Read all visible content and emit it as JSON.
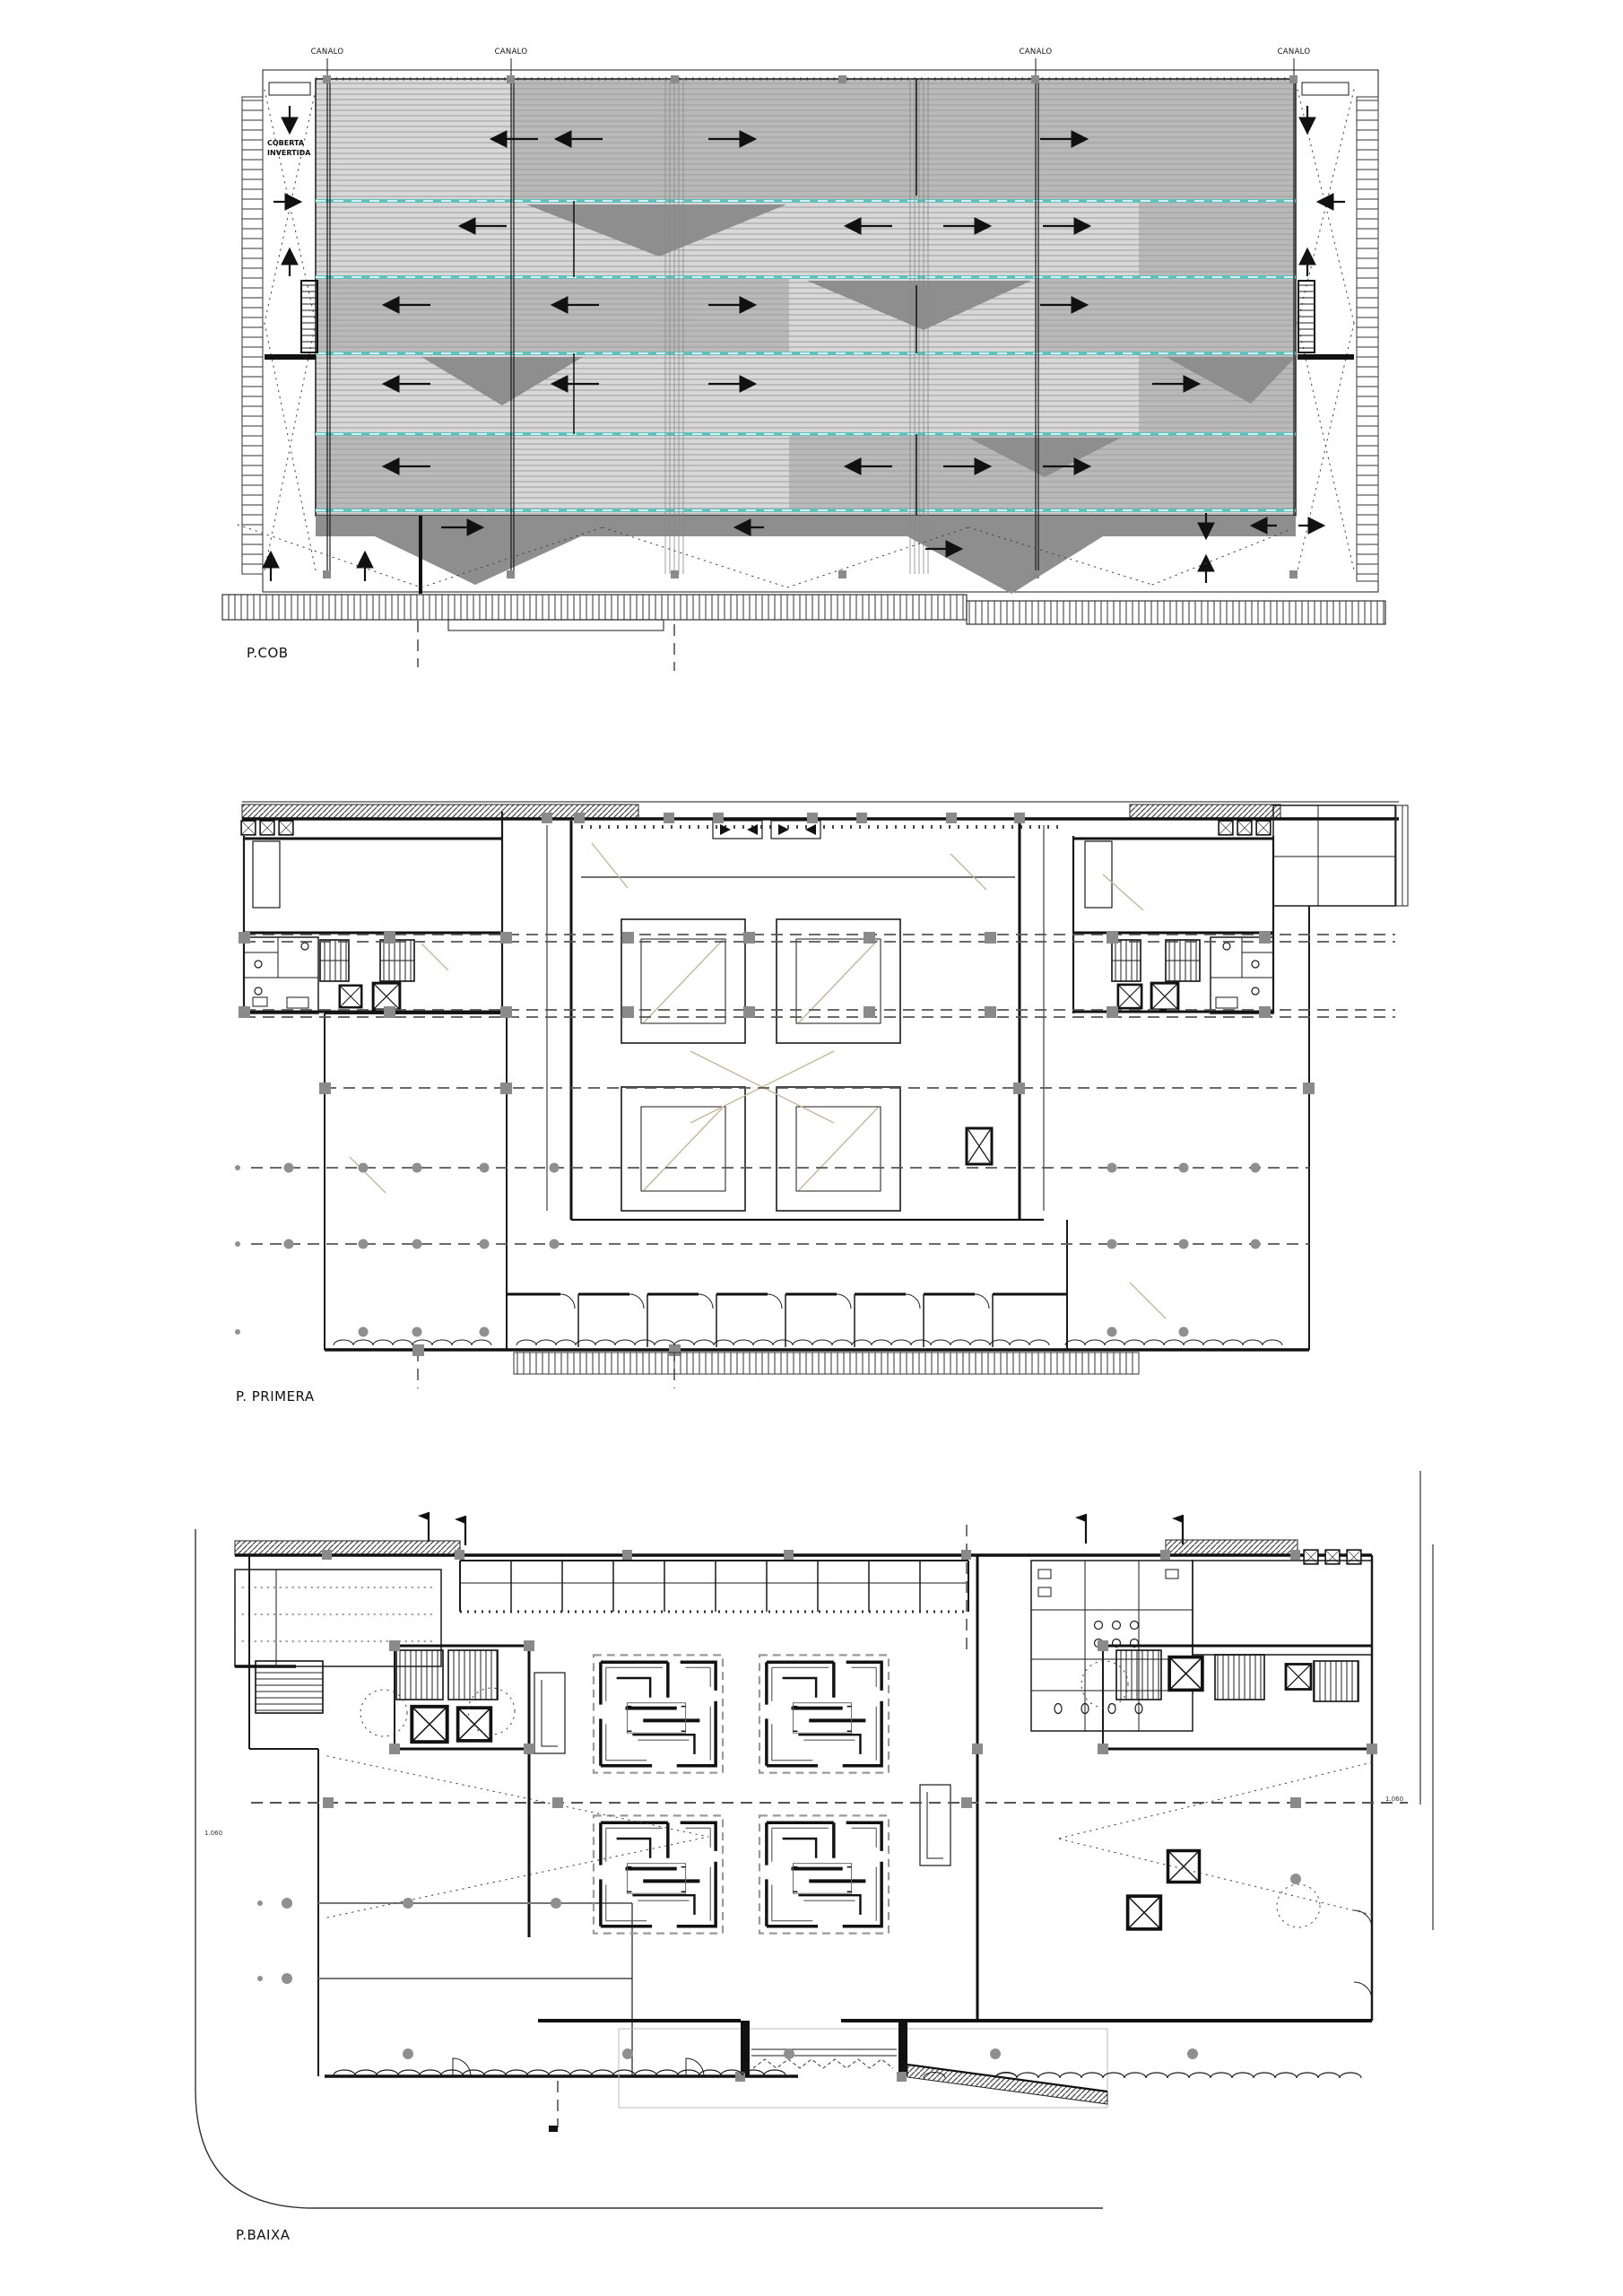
{
  "document": {
    "title": "Architectural plans sheet",
    "background": "#ffffff"
  },
  "colors": {
    "line": "#1a1a1a",
    "roof_light": "#d8d8d8",
    "roof_dark": "#b9b9b9",
    "roof_shadow": "#8e8e8e",
    "gutter_teal": "#5ec1bd",
    "column_gray": "#8a8a8a",
    "axis_tan": "#c9b496"
  },
  "plans": {
    "roof": {
      "label": "P.COB",
      "canal_label": "CANALO",
      "note_line1": "COBERTA",
      "note_line2": "INVERTIDA"
    },
    "first": {
      "label": "P. PRIMERA"
    },
    "ground": {
      "label": "P.BAIXA",
      "level_marker": "1.060"
    }
  }
}
